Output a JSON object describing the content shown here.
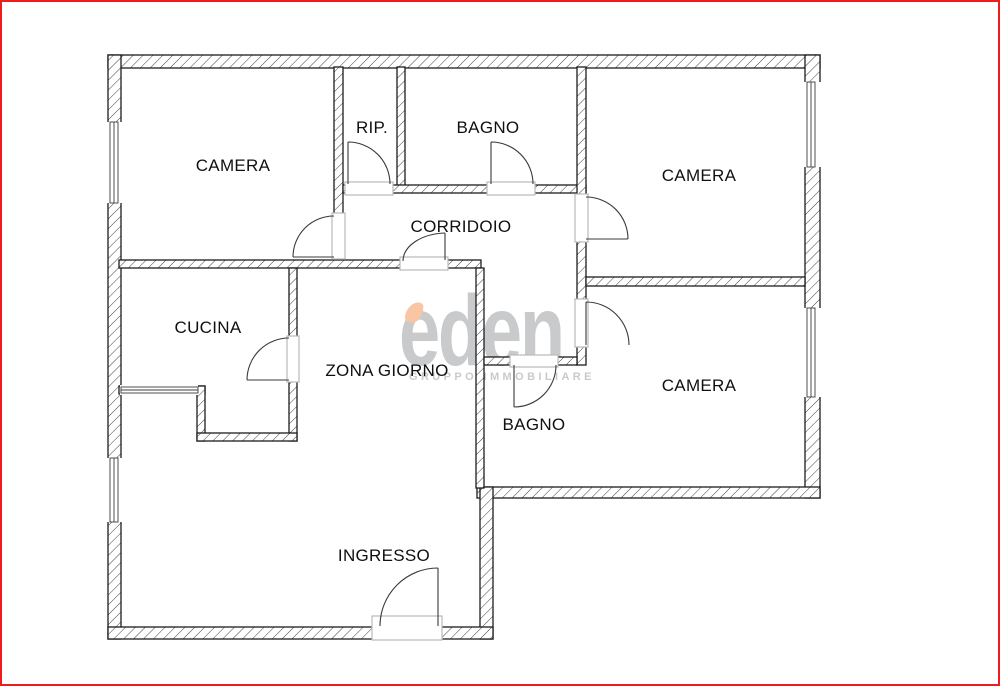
{
  "theme": {
    "frame_red": "#f21b1b",
    "wall_ink": "#1c1c1c",
    "door_ink": "#3a3a3a",
    "sill_gray": "#b9b9b9",
    "watermark_gray": "#c8cacc",
    "leaf_peach": "#f8c6a2",
    "label_ink": "#101010",
    "bg": "#ffffff"
  },
  "rooms": [
    {
      "id": "camera-top-left",
      "label": "CAMERA",
      "x": 233,
      "y": 166
    },
    {
      "id": "ripostiglio",
      "label": "RIP.",
      "x": 372,
      "y": 128
    },
    {
      "id": "bagno-top",
      "label": "BAGNO",
      "x": 488,
      "y": 128
    },
    {
      "id": "camera-top-right",
      "label": "CAMERA",
      "x": 699,
      "y": 176
    },
    {
      "id": "corridoio",
      "label": "CORRIDOIO",
      "x": 461,
      "y": 227
    },
    {
      "id": "cucina",
      "label": "CUCINA",
      "x": 208,
      "y": 328
    },
    {
      "id": "zona-giorno",
      "label": "ZONA GIORNO",
      "x": 387,
      "y": 371
    },
    {
      "id": "bagno-bottom",
      "label": "BAGNO",
      "x": 534,
      "y": 425
    },
    {
      "id": "camera-bottom-right",
      "label": "CAMERA",
      "x": 699,
      "y": 386
    },
    {
      "id": "ingresso",
      "label": "INGRESSO",
      "x": 384,
      "y": 556
    }
  ],
  "watermark": {
    "brand": "eden",
    "tagline": "GRUPPO IMMOBILIARE"
  }
}
